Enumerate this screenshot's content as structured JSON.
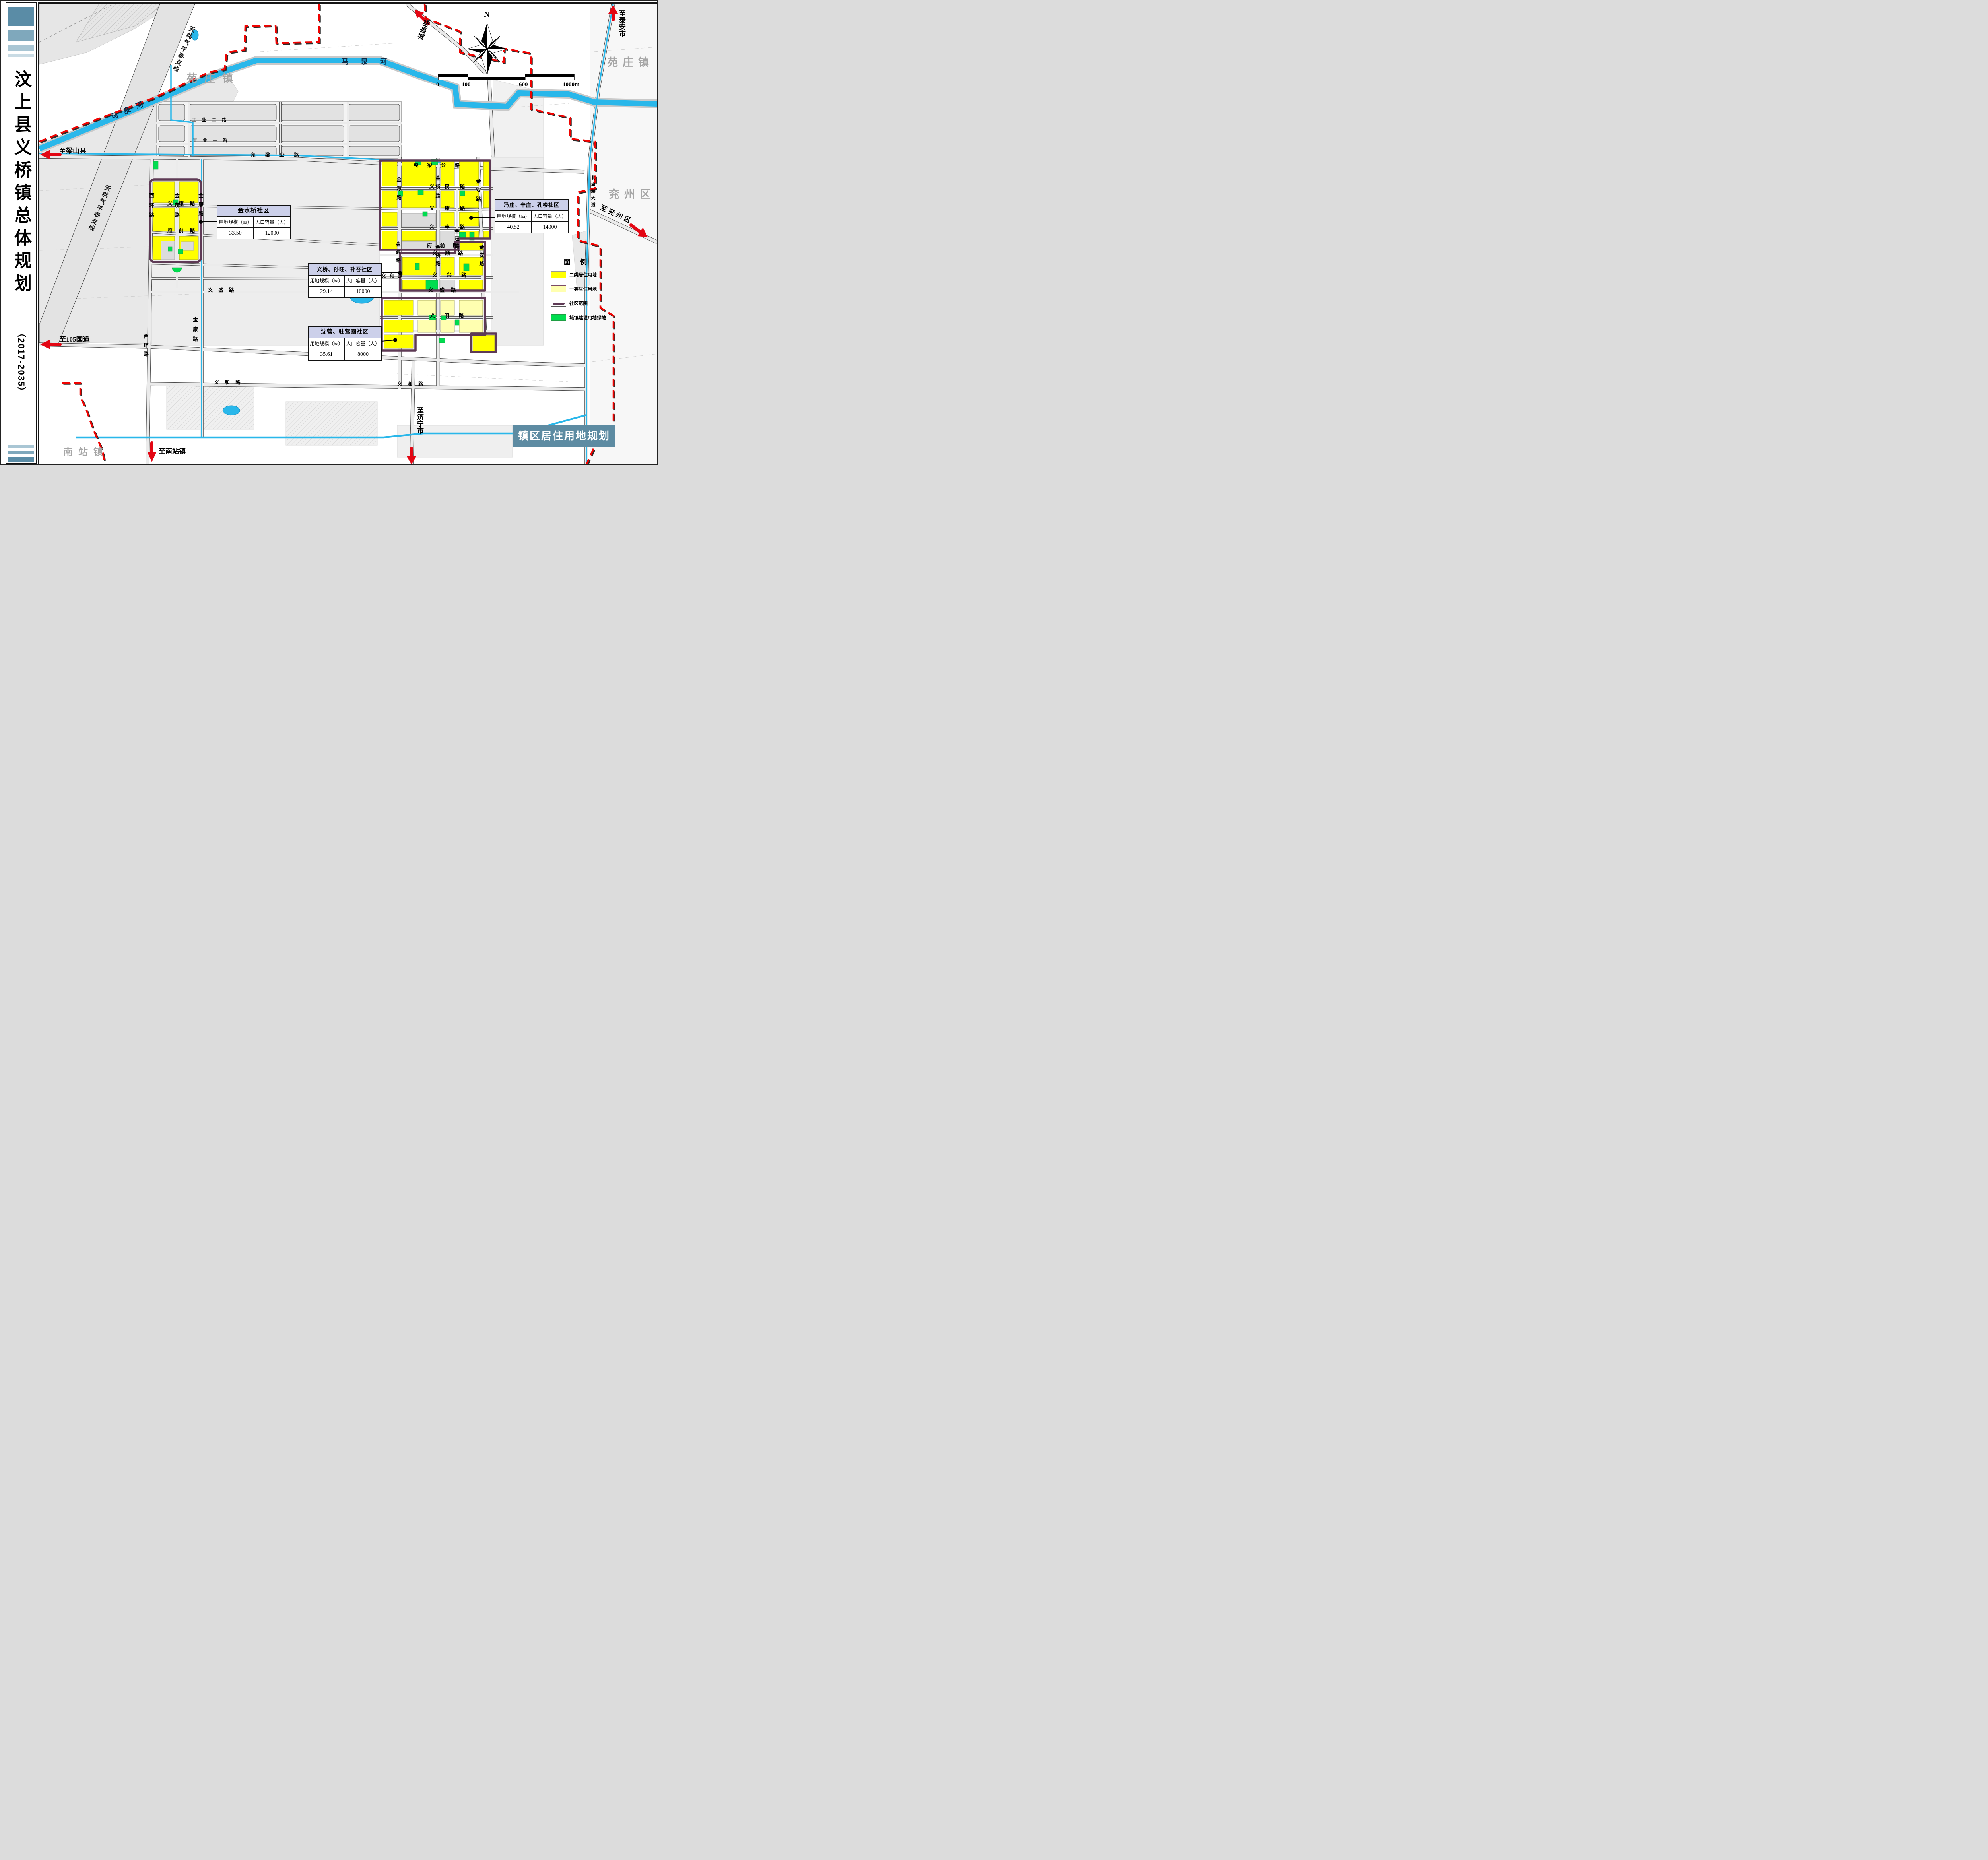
{
  "document_title": "汶上县义桥镇总体规划（2017-2035）",
  "sidebar": {
    "title": "汶上县义桥镇总体规划",
    "subtitle": "（2017-2035）"
  },
  "map_title_box": "镇区居住用地规划图",
  "compass_n": "N",
  "scalebar": {
    "t0": "0",
    "t1": "100",
    "t2": "600",
    "t3": "1000m"
  },
  "regions": {
    "yuanzhuang_left": "苑庄镇",
    "yuanzhuang_right": "苑庄镇",
    "yanzhou": "兖州区",
    "nanzhan": "南站镇"
  },
  "rivers": {
    "maquan_diag": "马泉河",
    "maquan_horiz": "马泉河"
  },
  "pipeline": {
    "label_a": "天然气平泰支线",
    "label_b": "天然气平泰支线"
  },
  "directions": {
    "liangshan": "至梁山县",
    "g105": "至105国道",
    "nanzhan": "至南站镇",
    "jining": "至济宁市",
    "xiancheng": "至县城",
    "taian": "至泰安市",
    "yanzhou": "至兖州区"
  },
  "roads": {
    "yanliang_w": "兖梁公路",
    "yanliang_e": "兖梁公路",
    "yimin": "义民路",
    "yikang_w": "义康路",
    "yikang_e": "义康路",
    "yifeng": "义丰路",
    "fuqian_w": "府前路",
    "fuqian_e": "府前路",
    "yishun": "义顺路",
    "yixing": "义兴路",
    "yihe_mid": "义和路",
    "yisheng_w": "义盛路",
    "yisheng_e": "义盛路",
    "yiming": "义明路",
    "yihe_s_w": "义和路",
    "yihe_s_e": "义和路",
    "gongye2": "工业二路",
    "gongye1": "工业一路",
    "xihuan_n": "西环路",
    "xihuan_s": "西环路",
    "jinmao": "金茂路",
    "jinkang_n": "金康路",
    "jinkang_s": "金康路",
    "jinyuan_n": "金源路",
    "jinyuan_s": "金源路",
    "jinqiao_n": "金桥路",
    "jinqiao_s": "金桥路",
    "jinwang": "金旺路",
    "jinan_n": "金安路",
    "jinan_s": "金安路",
    "beilvyou": "北旅游大道"
  },
  "legend": {
    "title": "图 例",
    "items": [
      {
        "label": "二类居住用地",
        "color": "#ffff00"
      },
      {
        "label": "一类居住用地",
        "color": "#ffffb0"
      },
      {
        "label": "社区范围",
        "color": "#5e3a55"
      },
      {
        "label": "城镇建设用地绿地",
        "color": "#00dd4f"
      }
    ]
  },
  "table_headers": {
    "area": "用地规模（ha）",
    "population": "人口容量（人）"
  },
  "communities": [
    {
      "name": "金水桥社区",
      "area": "33.50",
      "population": "12000"
    },
    {
      "name": "冯庄、辛庄、孔楼社区",
      "area": "40.52",
      "population": "14000"
    },
    {
      "name": "义桥、孙旺、孙吾社区",
      "area": "29.14",
      "population": "10000"
    },
    {
      "name": "沈营、驻驾圈社区",
      "area": "35.61",
      "population": "8000"
    }
  ],
  "colors": {
    "river": "#29b7ea",
    "boundary_red": "#f00200",
    "community_purple": "#5e3a55",
    "residential2": "#ffff00",
    "residential1": "#ffffb0",
    "green_land": "#00dd4f",
    "sidebar_teal": "#5a8ca6",
    "title_box_teal": "#5d8ba2",
    "info_header": "#ccd0ea"
  }
}
